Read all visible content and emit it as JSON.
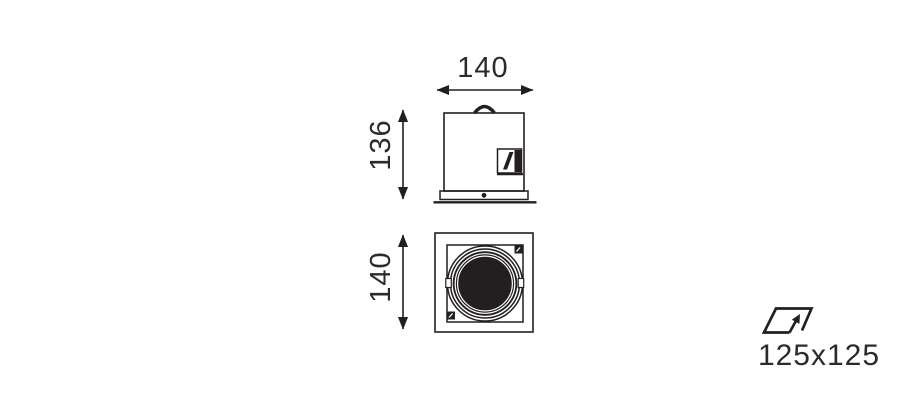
{
  "colors": {
    "bg": "#ffffff",
    "line": "#231f20",
    "text": "#2d2a2b"
  },
  "side_view": {
    "width_label": "140",
    "height_label": "136"
  },
  "front_view": {
    "height_label": "140"
  },
  "cutout": {
    "label": "125x125",
    "icon": "ceiling-cutout-icon"
  }
}
